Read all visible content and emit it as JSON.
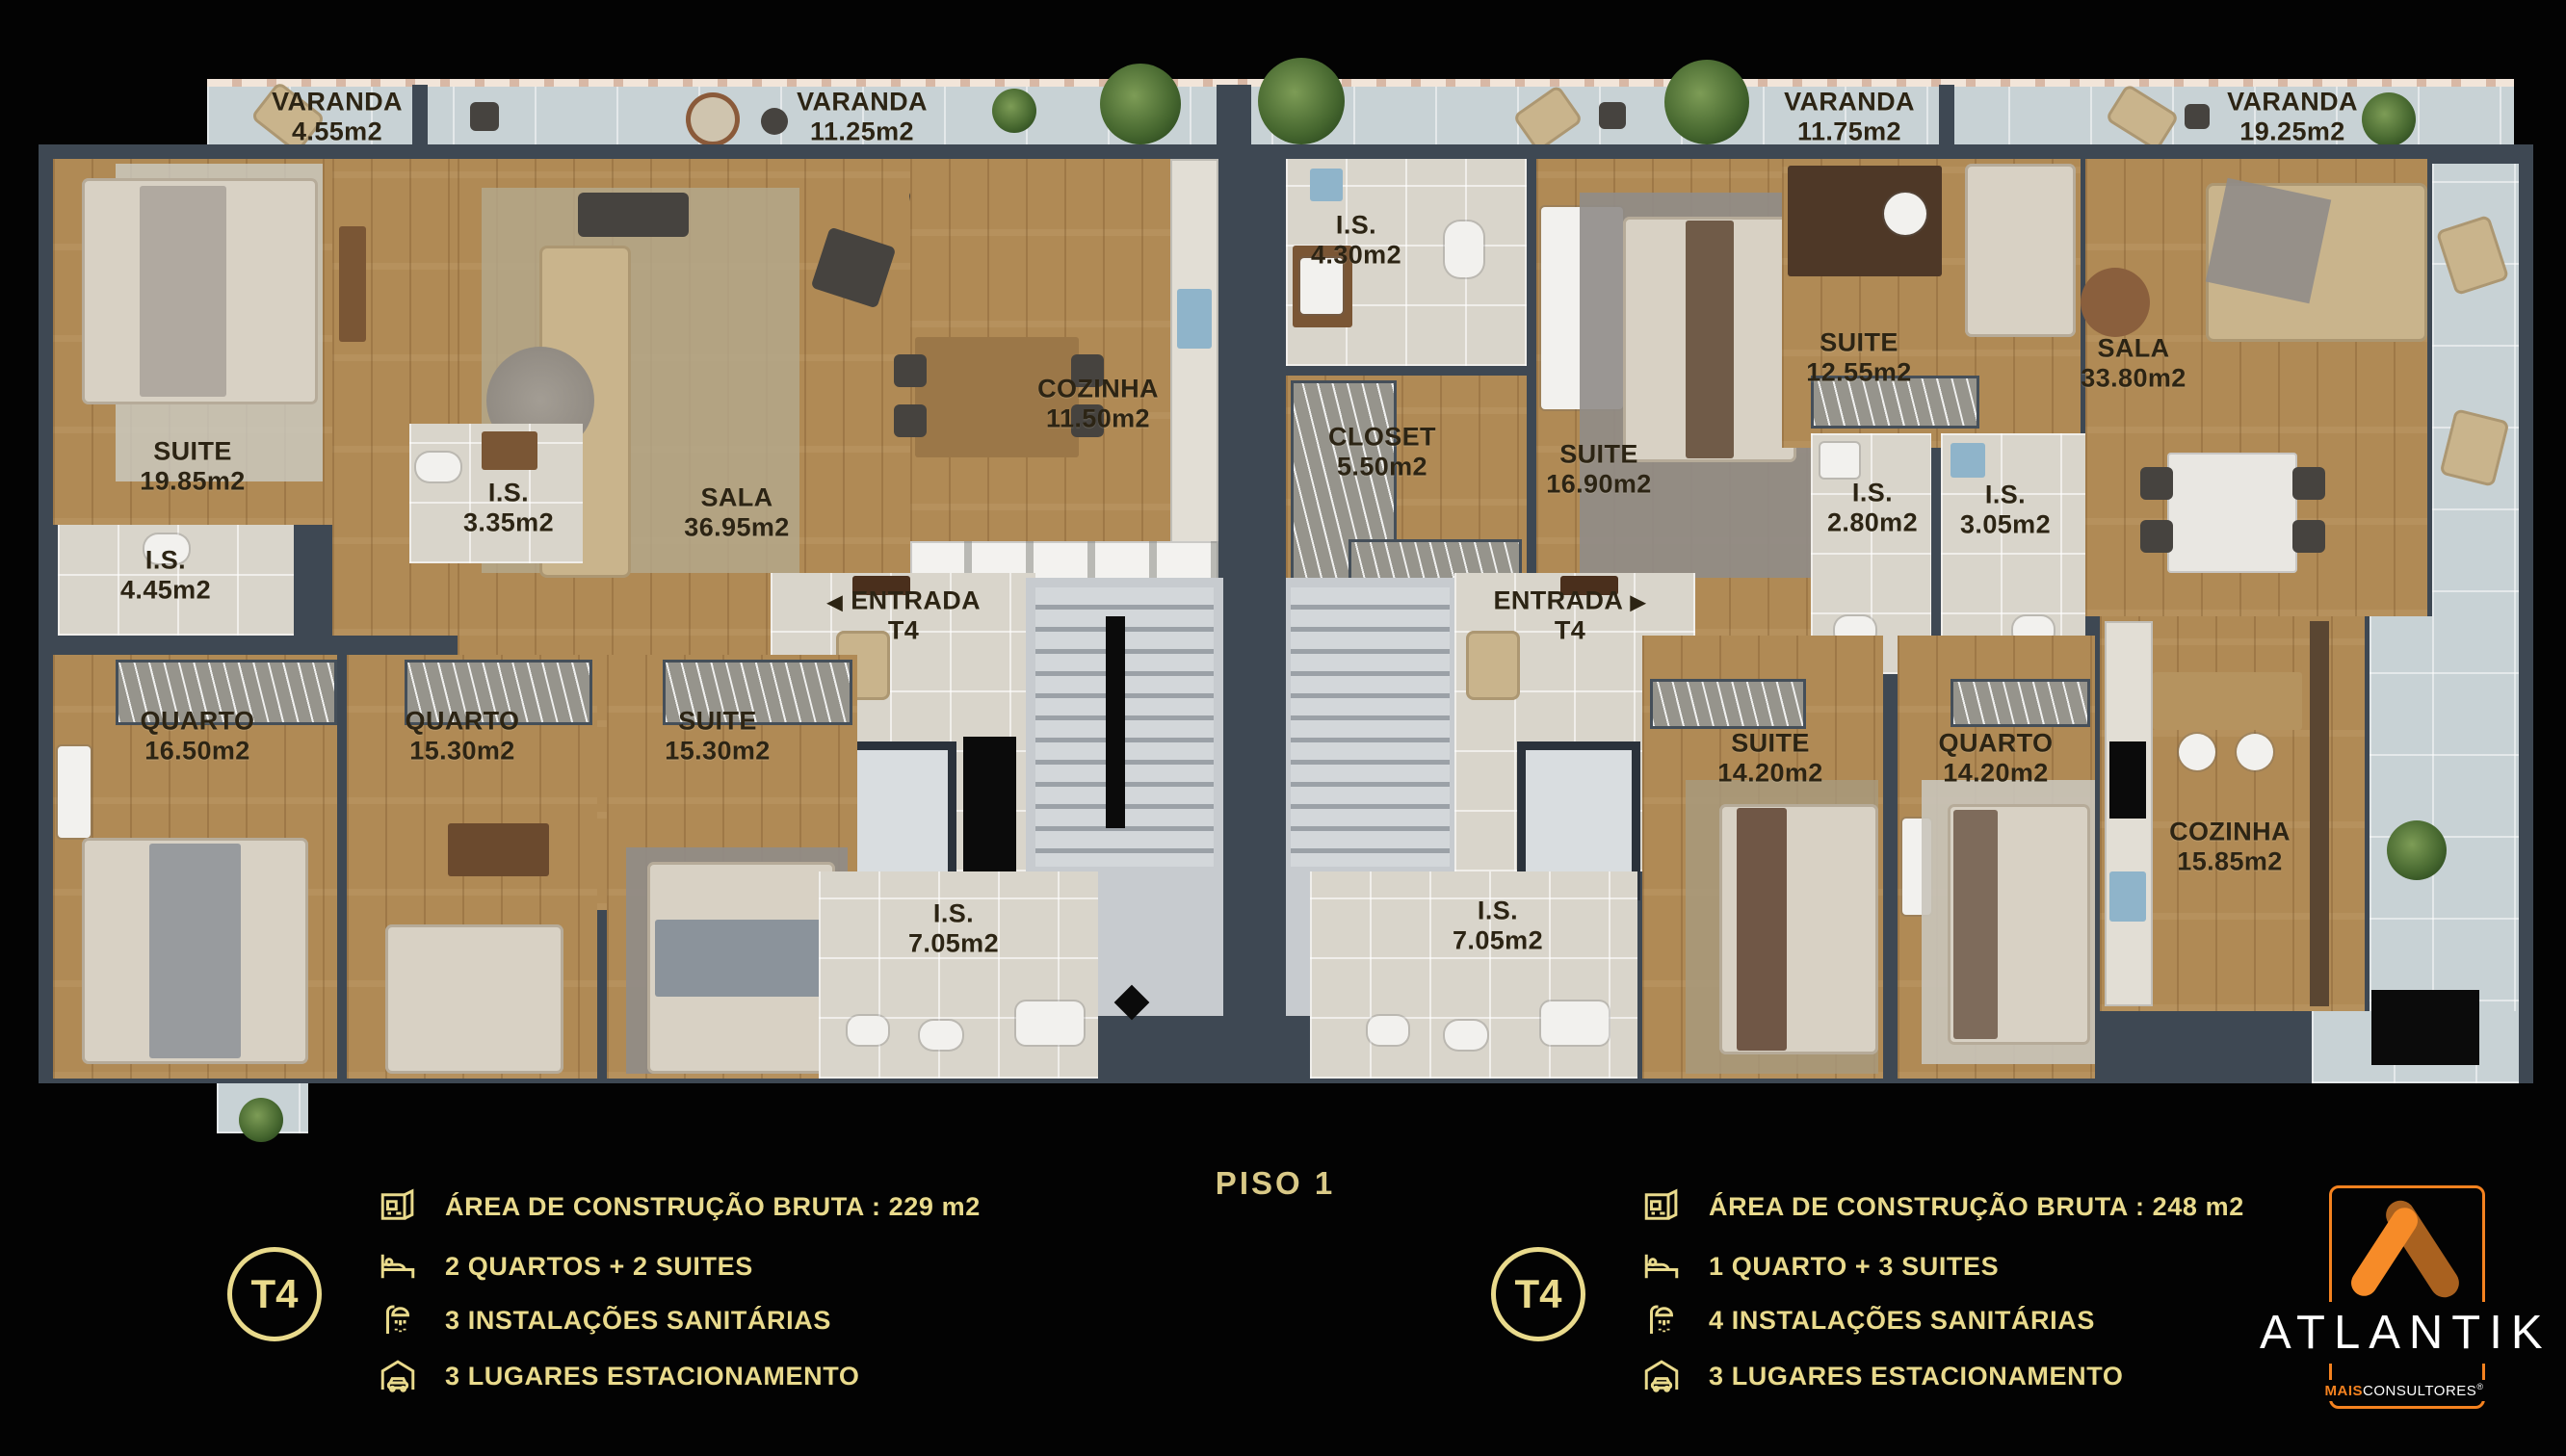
{
  "floor_title": "PISO 1",
  "varandas": [
    {
      "name": "VARANDA",
      "area": "4.55m2"
    },
    {
      "name": "VARANDA",
      "area": "11.25m2"
    },
    {
      "name": "VARANDA",
      "area": "11.75m2"
    },
    {
      "name": "VARANDA",
      "area": "19.25m2"
    }
  ],
  "unit_left": {
    "entrada": {
      "line1": "ENTRADA",
      "line2": "T4",
      "arrow": "◀"
    },
    "rooms": [
      {
        "name": "SUITE",
        "area": "19.85m2"
      },
      {
        "name": "I.S.",
        "area": "4.45m2"
      },
      {
        "name": "I.S.",
        "area": "3.35m2"
      },
      {
        "name": "SALA",
        "area": "36.95m2"
      },
      {
        "name": "COZINHA",
        "area": "11.50m2"
      },
      {
        "name": "QUARTO",
        "area": "16.50m2"
      },
      {
        "name": "QUARTO",
        "area": "15.30m2"
      },
      {
        "name": "SUITE",
        "area": "15.30m2"
      },
      {
        "name": "I.S.",
        "area": "7.05m2"
      }
    ]
  },
  "unit_right": {
    "entrada": {
      "line1": "ENTRADA",
      "line2": "T4",
      "arrow": "▶"
    },
    "rooms": [
      {
        "name": "I.S.",
        "area": "4.30m2"
      },
      {
        "name": "CLOSET",
        "area": "5.50m2"
      },
      {
        "name": "SUITE",
        "area": "16.90m2"
      },
      {
        "name": "SUITE",
        "area": "12.55m2"
      },
      {
        "name": "I.S.",
        "area": "2.80m2"
      },
      {
        "name": "I.S.",
        "area": "3.05m2"
      },
      {
        "name": "SALA",
        "area": "33.80m2"
      },
      {
        "name": "SUITE",
        "area": "14.20m2"
      },
      {
        "name": "QUARTO",
        "area": "14.20m2"
      },
      {
        "name": "COZINHA",
        "area": "15.85m2"
      },
      {
        "name": "I.S.",
        "area": "7.05m2"
      }
    ]
  },
  "legend_left": {
    "badge": "T4",
    "rows": [
      {
        "icon": "floorplan-icon",
        "text": "ÁREA DE CONSTRUÇÃO BRUTA :  229 m2"
      },
      {
        "icon": "bed-icon",
        "text": "2 QUARTOS + 2 SUITES"
      },
      {
        "icon": "shower-icon",
        "text": "3 INSTALAÇÕES SANITÁRIAS"
      },
      {
        "icon": "garage-icon",
        "text": "3 LUGARES ESTACIONAMENTO"
      }
    ]
  },
  "legend_right": {
    "badge": "T4",
    "rows": [
      {
        "icon": "floorplan-icon",
        "text": "ÁREA DE CONSTRUÇÃO BRUTA :  248 m2"
      },
      {
        "icon": "bed-icon",
        "text": "1 QUARTO + 3 SUITES"
      },
      {
        "icon": "shower-icon",
        "text": "4 INSTALAÇÕES SANITÁRIAS"
      },
      {
        "icon": "garage-icon",
        "text": "3 LUGARES ESTACIONAMENTO"
      }
    ]
  },
  "brand": {
    "name": "ATLANTIK",
    "sub_bold": "MAIS",
    "sub_regular": "CONSULTORES",
    "registered": "®"
  },
  "colors": {
    "legend_gold": "#e9da8c",
    "brand_orange": "#f5821f",
    "brand_dark_orange": "#a9611f",
    "wall": "#3e4853",
    "wood_floor": "#b08a55",
    "bath_tile": "#d9d5cb",
    "varanda_tile": "#c8d2d5"
  }
}
